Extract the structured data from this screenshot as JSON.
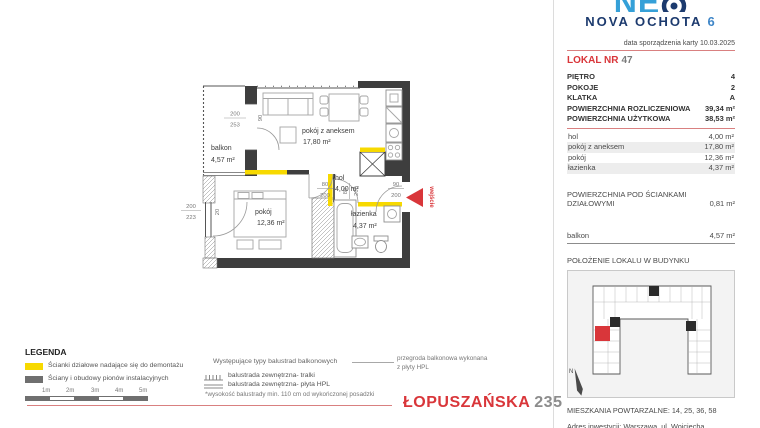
{
  "brand": {
    "logo_text": "NE",
    "name_main": "NOVA OCHOTA",
    "name_number": "6"
  },
  "header": {
    "date_line": "data sporządzenia karty 10.03.2025"
  },
  "lokal": {
    "label": "LOKAL NR",
    "number": "47"
  },
  "details": [
    {
      "label": "PIĘTRO",
      "value": "4"
    },
    {
      "label": "POKOJE",
      "value": "2"
    },
    {
      "label": "KLATKA",
      "value": "A"
    },
    {
      "label": "POWIERZCHNIA ROZLICZENIOWA",
      "value": "39,34 m²"
    },
    {
      "label": "POWIERZCHNIA UŻYTKOWA",
      "value": "38,53 m²"
    }
  ],
  "rooms": [
    {
      "label": "hol",
      "value": "4,00 m²"
    },
    {
      "label": "pokój z aneksem",
      "value": "17,80 m²"
    },
    {
      "label": "pokój",
      "value": "12,36 m²"
    },
    {
      "label": "łazienka",
      "value": "4,37 m²"
    }
  ],
  "partition": {
    "label_line1": "POWIERZCHNIA POD ŚCIANKAMI",
    "label_line2": "DZIAŁOWYMI",
    "value": "0,81 m²"
  },
  "balcony_row": {
    "label": "balkon",
    "value": "4,57 m²"
  },
  "location": {
    "header": "POŁOŻENIE LOKALU W BUDYNKU",
    "north_label": "N"
  },
  "footer_right": {
    "repeat_line": "MIESZKANIA POWTARZALNE: 14, 25, 36, 58",
    "address_line": "Adres inwestycji: Warszawa, ul. Wojciecha Opackiego 6"
  },
  "plan": {
    "balkon": {
      "name": "balkon",
      "area": "4,57 m²"
    },
    "living": {
      "name": "pokój z aneksem",
      "area": "17,80 m²"
    },
    "hol": {
      "name": "hol",
      "area": "4,00 m²"
    },
    "bedroom": {
      "name": "pokój",
      "area": "12,36 m²"
    },
    "bath": {
      "name": "łazienka",
      "area": "4,37 m²"
    },
    "entrance_label": "wejście",
    "dims": {
      "balcony_door": {
        "w": "200",
        "h": "253"
      },
      "balcony_leaf": "90",
      "bedroom_window": {
        "w": "200",
        "h": "223"
      },
      "bedroom_window_side": "20",
      "hol_door": {
        "w": "80",
        "h": "200"
      },
      "bath_door": {
        "w": "80",
        "h": "200"
      },
      "entry_door": {
        "w": "90",
        "h": "200"
      }
    }
  },
  "legend": {
    "title": "LEGENDA",
    "items": [
      {
        "label": "Ścianki działowe nadające się do demontażu"
      },
      {
        "label": "Ściany i obudowy pionów instalacyjnych"
      }
    ],
    "scale_labels": [
      "1m",
      "2m",
      "3m",
      "4m",
      "5m"
    ],
    "balustrade_title": "Występujące typy balustrad balkonowych",
    "balustrade_items": [
      {
        "label": "balustrada zewnętrzna- tralki"
      },
      {
        "label": "balustrada zewnętrzna- płyta HPL"
      }
    ],
    "balustrade_note": "*wysokość balustrady min. 110 cm od wykończonej posadzki",
    "hpl_note_line1": "przegroda balkonowa wykonana",
    "hpl_note_line2": "z płyty HPL"
  },
  "street": {
    "name": "ŁOPUSZAŃSKA",
    "number": "235"
  },
  "colors": {
    "accent_red": "#d9363a",
    "separator_red": "#d98080",
    "partition_yellow": "#f7d900",
    "wall_dark": "#3e3e3e",
    "navy": "#1c3a6e",
    "light_blue": "#35a0d8"
  }
}
